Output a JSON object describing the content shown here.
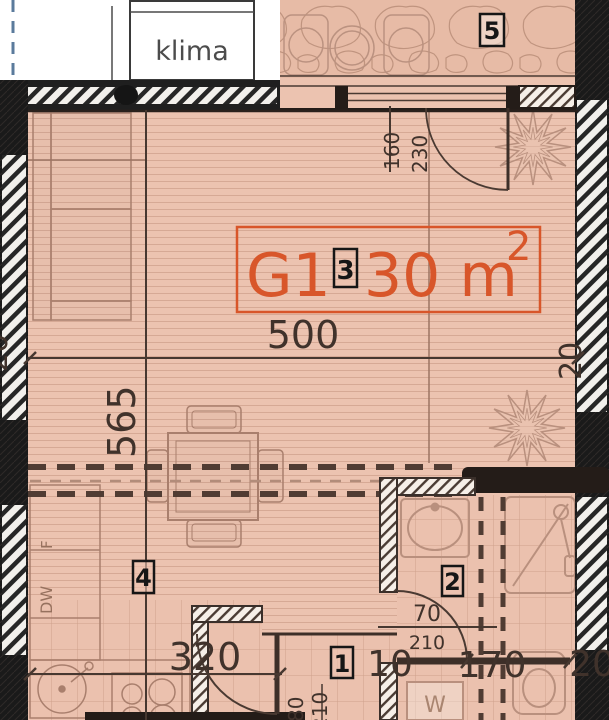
{
  "unit": {
    "name": "G1",
    "area": "30 m",
    "area_exp": "2",
    "zone_box": "3"
  },
  "room_boxes": {
    "terrace": "5",
    "bathroom": "2",
    "kitchen": "4",
    "entry": "1"
  },
  "equipment": {
    "klima": "klima",
    "fridge": "F",
    "dishwasher": "DW",
    "washer": "W"
  },
  "dims": {
    "room_width": "500",
    "room_depth": "565",
    "kitchen_run": "320",
    "balcony_door_w": "160",
    "balcony_door_h": "230",
    "bath_door_w": "70",
    "bath_door_h": "210",
    "entry_door_w": "80",
    "entry_door_h": "210",
    "seg_10": "10",
    "seg_170": "170",
    "wall_left": "20",
    "wall_right": "20",
    "wall_bottom_right": "20"
  },
  "colors": {
    "accent": "#d8562a",
    "floor": "#ecc3b0",
    "wall": "#1b1b1b"
  }
}
